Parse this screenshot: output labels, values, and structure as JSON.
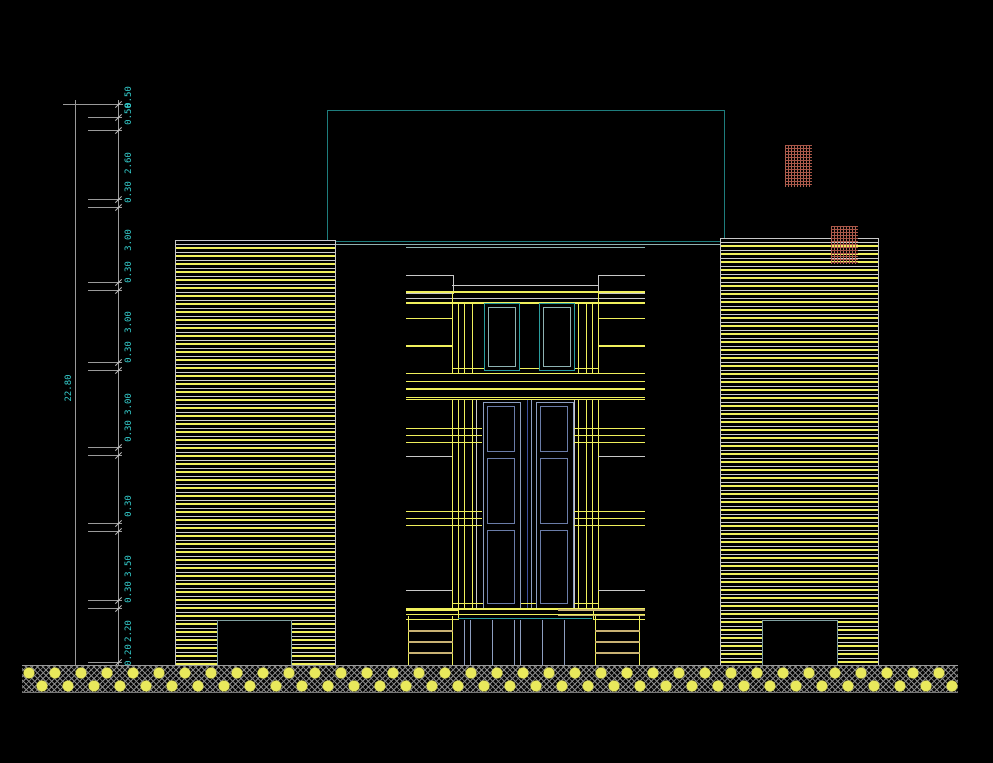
{
  "drawing": {
    "type": "architectural-elevation",
    "title": "Building front elevation (CAD)",
    "storeys_visible": 5
  },
  "dimensions": {
    "overall": "22.80",
    "chain": [
      "0.50",
      "0.50",
      "2.60",
      "0.30",
      "3.00",
      "0.30",
      "3.00",
      "0.30",
      "3.00",
      "0.30",
      "0.30",
      "3.50",
      "0.30",
      "2.20",
      "0.20"
    ]
  },
  "colors": {
    "background": "#000000",
    "line_yellow": "#f0f05c",
    "line_white": "#c8c8c8",
    "line_teal": "#2a9d9d",
    "penthouse_teal": "#1e7d7d",
    "dim_text_cyan": "#35cfcf",
    "dim_line_grey": "#9a9a9a",
    "brick_red": "#a85648",
    "tan": "#c9b273",
    "door_blue": "#8d9ec0"
  }
}
